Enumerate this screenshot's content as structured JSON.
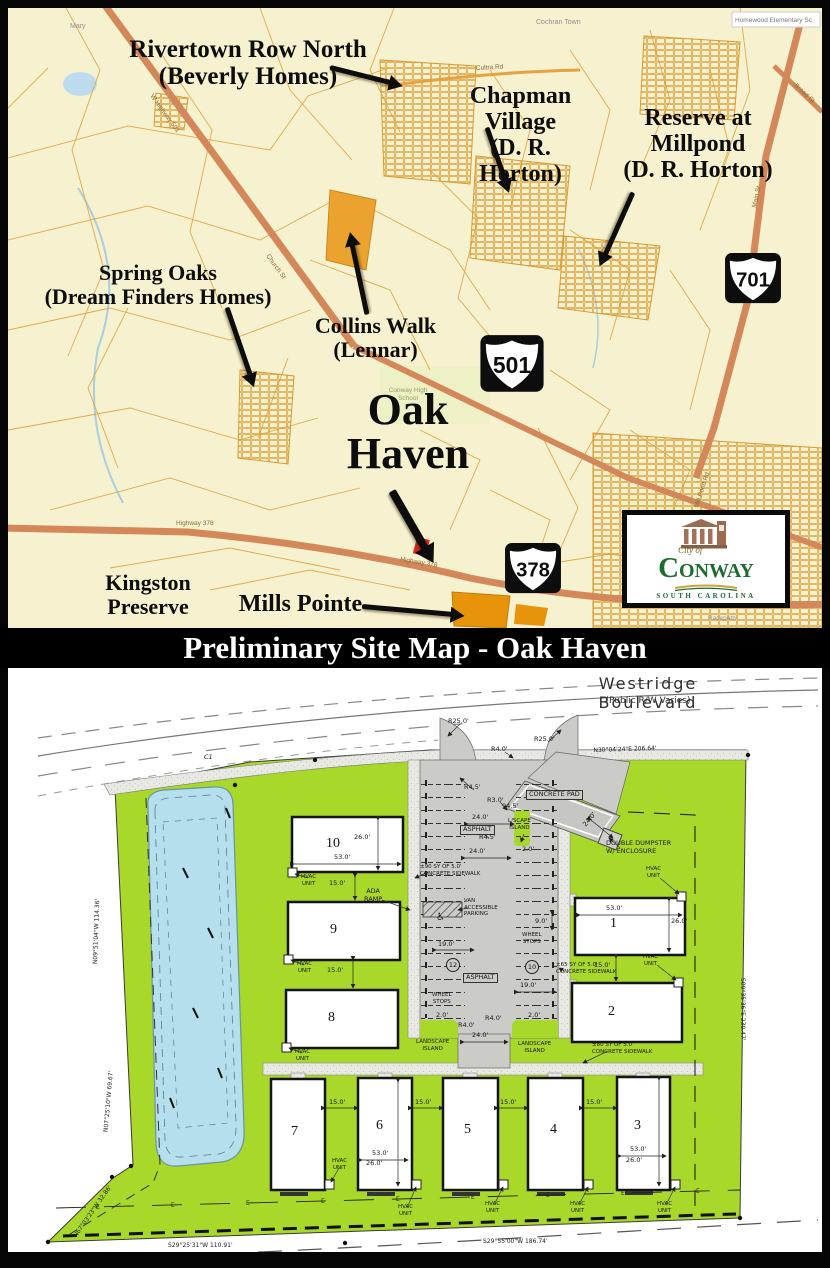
{
  "banner": {
    "title": "Preliminary Site Map - Oak Haven"
  },
  "map": {
    "annotations": {
      "rivertown": "Rivertown Row North\n(Beverly Homes)",
      "chapman": "Chapman\nVillage\n(D. R. Horton)",
      "reserve": "Reserve at\nMillpond\n(D. R. Horton)",
      "spring_oaks": "Spring Oaks\n(Dream Finders Homes)",
      "collins_walk": "Collins Walk\n(Lennar)",
      "oak_haven": "Oak\nHaven",
      "kingston": "Kingston\nPreserve",
      "mills_pointe": "Mills Pointe"
    },
    "shields": {
      "us701": "701",
      "us501": "501",
      "us378": "378"
    },
    "road_labels": {
      "w_hwy_501": "W Highway 501",
      "church_st": "Church St",
      "cultra_rd": "Cultra Rd",
      "highway_378": "Highway 378",
      "broad_st": "Broad St",
      "main_st": "Main St",
      "mill_pond_rd": "Mill Pond Rd"
    },
    "place_labels": {
      "mary": "Mary",
      "cochran_town": "Cochran Town",
      "homewood": "Homewood Elementary Sc",
      "conway_hs": "Conway High\nSchool",
      "buckwood": "Buckwood\nJackins Field",
      "racepath": "Racepath"
    },
    "logo": {
      "city_of": "City of",
      "c": "C",
      "rest": "ONWAY",
      "state": "SOUTH CAROLINA"
    }
  },
  "site_plan": {
    "street": {
      "name": "Westridge Boulevard",
      "subtitle": "(Public R/W Varies)"
    },
    "buildings": {
      "b1": "1",
      "b2": "2",
      "b3": "3",
      "b4": "4",
      "b5": "5",
      "b6": "6",
      "b7": "7",
      "b8": "8",
      "b9": "9",
      "b10": "10"
    },
    "labels": {
      "asphalt": "ASPHALT",
      "concrete_pad": "CONCRETE PAD",
      "lscape_island": "L/SCAPE\nISLAND",
      "landscape_island": "LANDSCAPE\nISLAND",
      "van_parking": "VAN\nACCESSIBLE\nPARKING",
      "ada_ramp": "ADA\nRAMP",
      "wheel_stops": "WHEEL\nSTOPS",
      "dumpster": "DOUBLE DUMPSTER\nW/ ENCLOSURE",
      "hvac": "HVAC\nUNIT",
      "sw90": "±90 SY OF 5.0'\nCONCRETE SIDEWALK",
      "sw65": "±65 SY OF 5.0'\nCONCRETE SIDEWALK",
      "sw80": "±80 SY OF 5.0'\nCONCRETE SIDEWALK",
      "e_marker": "E",
      "handicap": "♿"
    },
    "dims": {
      "r25": "R25.0'",
      "r4": "R4.0'",
      "r45": "R4.5'",
      "r3": "R3.0'",
      "d24": "24.0'",
      "d2": "2.0'",
      "d19": "19.0'",
      "d9": "9.0'",
      "d15": "15.0'",
      "d53": "53.0'",
      "d26": "26.0'",
      "d945": "94.5'",
      "c1": "C1",
      "stall12": "12",
      "stall10": "10"
    },
    "bearings": {
      "top": "N30°04'24\"E   206.64'",
      "right": "S09°35'36\"E   230.47'",
      "bottom_left": "S29°25'31\"W   110.91'",
      "bottom_right": "S29°55'00\"W   186.74'",
      "left_upper": "N09°51'04\"W   114.36'",
      "left_mid": "N07°25'10\"W   69.67'",
      "left_lower": "N67°03'23\"W   32.86'"
    }
  },
  "colors": {
    "map_bg": "#f6f1cf",
    "parcel_line": "#e1a23b",
    "major_road": "#d4885a",
    "site_green": "#a8d829",
    "pond_blue": "#b5dfed",
    "asphalt_gray": "#cbcbc7",
    "highlight_red": "#e3221a",
    "subdiv_orange": "#eca22e",
    "logo_green": "#1d6b30"
  }
}
